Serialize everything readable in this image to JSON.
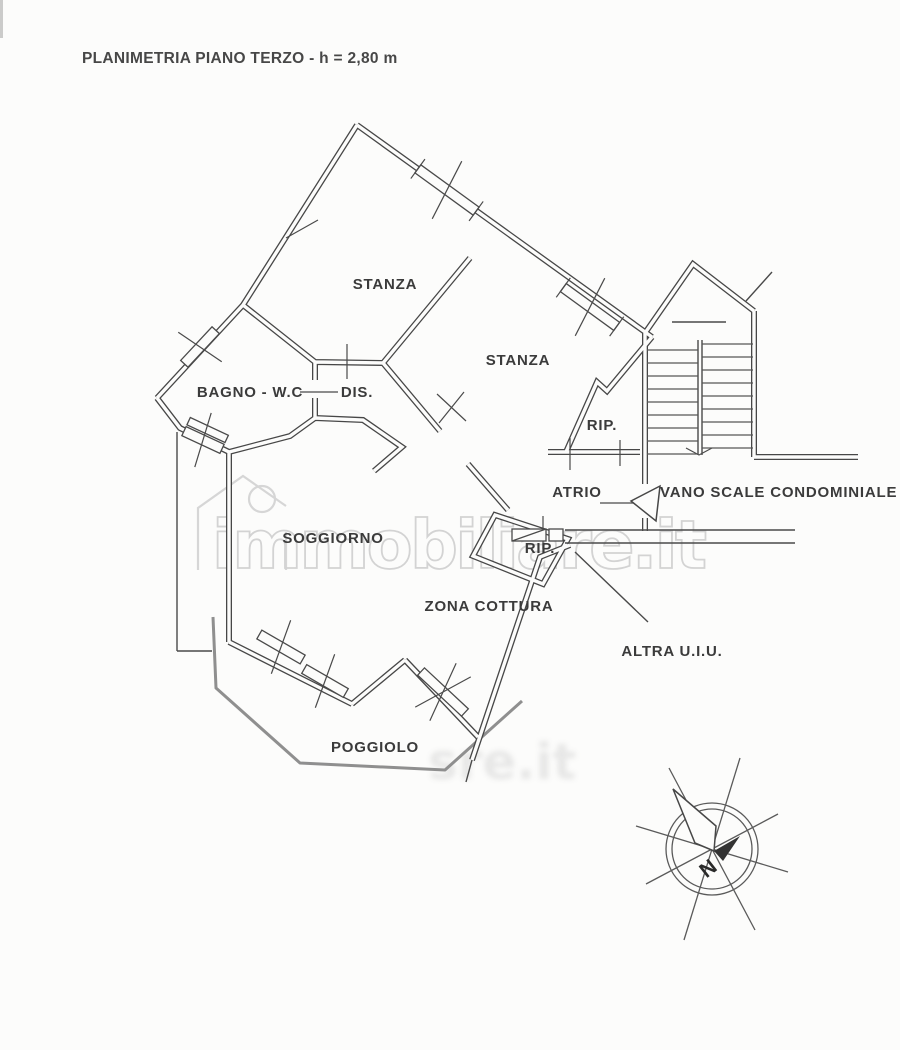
{
  "page": {
    "title": "PLANIMETRIA PIANO TERZO - h = 2,80 m"
  },
  "rooms": {
    "stanza1": "STANZA",
    "stanza2": "STANZA",
    "bagno": "BAGNO - W.C",
    "dis": "DIS.",
    "rip1": "RIP.",
    "atrio": "ATRIO",
    "vano_scale": "VANO SCALE CONDOMINIALE",
    "rip2": "RIP.",
    "soggiorno": "SOGGIORNO",
    "zona_cottura": "ZONA COTTURA",
    "altra_uiu": "ALTRA U.I.U.",
    "poggiolo": "POGGIOLO"
  },
  "watermark": {
    "text": "immobiliare.it",
    "blur_text": "sre.it"
  },
  "compass": {
    "north_label": "N"
  },
  "colors": {
    "wall_line": "#474747",
    "balcony_line": "#8f8f8f",
    "watermark_gray": "#d2d2d2",
    "label_color": "#3b3b3b",
    "background": "#fcfcfb"
  }
}
